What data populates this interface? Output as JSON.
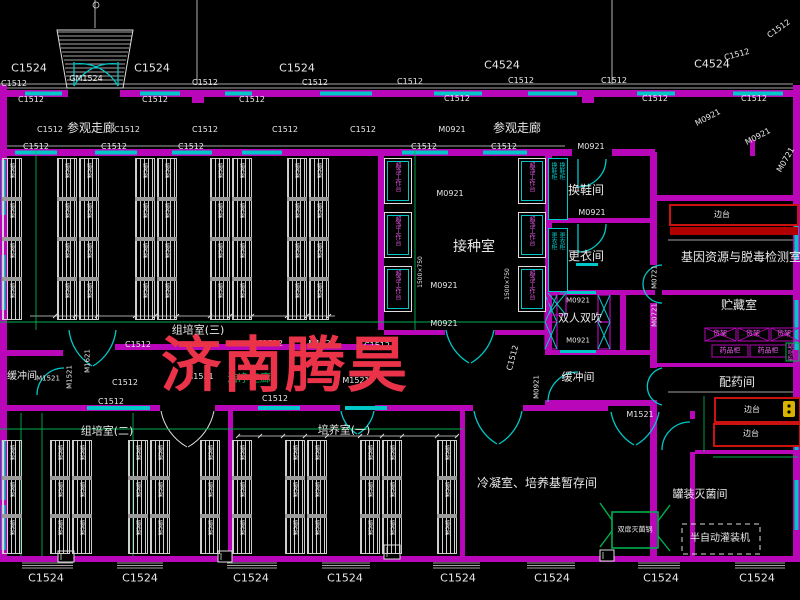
{
  "watermark": {
    "text": "济南腾昊",
    "color": "#ea3348"
  },
  "colors": {
    "wall": "#b806b8",
    "window": "#00c8c8",
    "line": "#dcdcdc",
    "green": "#00b050",
    "red": "#cc1111",
    "bench_red": "#b00000",
    "magenta_text": "#e85ae8",
    "yellow": "#d8b400",
    "text": "#e8e8e8"
  },
  "rooms": [
    "参观走廊",
    "组培室(三)",
    "接种室",
    "换鞋间",
    "更衣间",
    "双人双吹",
    "缓冲间",
    "洁净走廊",
    "基因资源与脱毒检测室",
    "贮藏室",
    "配药间",
    "罐装灭菌间",
    "组培室(二)",
    "培养室(一)",
    "冷凝室、培养基暂存间"
  ],
  "window_door_tags": [
    "C1524",
    "C4524",
    "C1512",
    "GM1524",
    "M0921",
    "M0721",
    "M1521",
    "M1621"
  ],
  "equipment": {
    "rack": "培养架",
    "clean_bench": "超净工作台",
    "shoe_cabinet": "换鞋柜",
    "wardrobe": "更衣柜",
    "side_bench": "边台",
    "shelf": "货架",
    "medicine_cabinet": "药品柜",
    "sterilizer": "双扉灭菌锅",
    "filler": "半自动灌装机"
  },
  "labels": [
    [
      "C1524",
      29,
      68,
      11
    ],
    [
      "C1524",
      152,
      68,
      11
    ],
    [
      "C1524",
      297,
      68,
      11
    ],
    [
      "C4524",
      502,
      65,
      11
    ],
    [
      "C4524",
      712,
      64,
      11
    ],
    [
      "C1512",
      737,
      55,
      8,
      null,
      -15
    ],
    [
      "C1512",
      779,
      29,
      8,
      null,
      -35
    ],
    [
      "GM1524",
      86,
      79,
      8
    ],
    [
      "C1512",
      14,
      84,
      8
    ],
    [
      "C1512",
      205,
      83,
      8
    ],
    [
      "C1512",
      315,
      83,
      8
    ],
    [
      "C1512",
      410,
      82,
      8
    ],
    [
      "C1512",
      521,
      81,
      8
    ],
    [
      "C1512",
      614,
      81,
      8
    ],
    [
      "C1512",
      31,
      100,
      8
    ],
    [
      "C1512",
      155,
      100,
      8
    ],
    [
      "C1512",
      252,
      100,
      8
    ],
    [
      "C1512",
      457,
      99,
      8
    ],
    [
      "C1512",
      655,
      99,
      8
    ],
    [
      "C1512",
      754,
      99,
      8
    ],
    [
      "参观走廊",
      91,
      128,
      12
    ],
    [
      "参观走廊",
      517,
      128,
      12
    ],
    [
      "C1512",
      50,
      130,
      8
    ],
    [
      "C1512",
      127,
      130,
      8
    ],
    [
      "C1512",
      205,
      130,
      8
    ],
    [
      "C1512",
      285,
      130,
      8
    ],
    [
      "C1512",
      363,
      130,
      8
    ],
    [
      "M0921",
      452,
      130,
      8
    ],
    [
      "M0921",
      708,
      118,
      8,
      null,
      -28
    ],
    [
      "M0921",
      758,
      137,
      8,
      null,
      -28
    ],
    [
      "M0721",
      786,
      160,
      8,
      null,
      -60
    ],
    [
      "C1512",
      36,
      147,
      8
    ],
    [
      "C1512",
      114,
      147,
      8
    ],
    [
      "C1512",
      191,
      147,
      8
    ],
    [
      "C1512",
      424,
      147,
      8
    ],
    [
      "C1512",
      504,
      147,
      8
    ],
    [
      "M0921",
      591,
      147,
      8
    ],
    [
      "M0921",
      450,
      194,
      8
    ],
    [
      "接种室",
      474,
      247,
      14
    ],
    [
      "M0921",
      444,
      286,
      8
    ],
    [
      "M0921",
      444,
      324,
      8
    ],
    [
      "1500×750",
      421,
      272,
      6,
      null,
      -90
    ],
    [
      "1500×750",
      508,
      284,
      6,
      null,
      -90
    ],
    [
      "换鞋间",
      586,
      190,
      12
    ],
    [
      "M0921",
      592,
      213,
      8
    ],
    [
      "更衣间",
      586,
      256,
      12
    ],
    [
      "双人双吹",
      580,
      318,
      11
    ],
    [
      "M0921",
      578,
      301,
      7
    ],
    [
      "M0921",
      578,
      341,
      7
    ],
    [
      "缓冲间",
      578,
      377,
      11
    ],
    [
      "M0921",
      537,
      387,
      7,
      null,
      -90
    ],
    [
      "C1512",
      513,
      358,
      8,
      null,
      -75
    ],
    [
      "M0721",
      655,
      277,
      7,
      null,
      -90
    ],
    [
      "M0721",
      655,
      315,
      7,
      null,
      -90
    ],
    [
      "基因资源与脱毒检测室",
      741,
      257,
      12
    ],
    [
      "边台",
      722,
      215,
      8
    ],
    [
      "贮藏室",
      739,
      305,
      12
    ],
    [
      "货架",
      720,
      334,
      7,
      "m"
    ],
    [
      "货架",
      753,
      334,
      7,
      "m"
    ],
    [
      "货架",
      784,
      334,
      7,
      "m"
    ],
    [
      "药品柜",
      730,
      351,
      7,
      "m"
    ],
    [
      "药品柜",
      768,
      351,
      7,
      "m"
    ],
    [
      "药品柜",
      792,
      352,
      6,
      "m",
      -90
    ],
    [
      "配药间",
      737,
      382,
      12
    ],
    [
      "边台",
      752,
      410,
      8
    ],
    [
      "边台",
      751,
      434,
      8
    ],
    [
      "罐装灭菌间",
      700,
      494,
      11
    ],
    [
      "半自动灌装机",
      720,
      539,
      10
    ],
    [
      "双扉灭菌锅",
      635,
      530,
      7
    ],
    [
      "冷凝室、培养基暂存间",
      537,
      483,
      12
    ],
    [
      "M1521",
      640,
      415,
      8
    ],
    [
      "组培室(三)",
      198,
      330,
      11
    ],
    [
      "组培室(二)",
      107,
      431,
      11
    ],
    [
      "培养室(一)",
      344,
      430,
      11
    ],
    [
      "洁净走廊",
      249,
      378,
      11,
      "g"
    ],
    [
      "缓冲间",
      22,
      377,
      10
    ],
    [
      "M1521",
      48,
      379,
      7
    ],
    [
      "M1621",
      88,
      361,
      7,
      null,
      -90
    ],
    [
      "M1521",
      70,
      377,
      7,
      null,
      -90
    ],
    [
      "C1512",
      138,
      345,
      8
    ],
    [
      "C1512",
      270,
      344,
      8
    ],
    [
      "M1521",
      322,
      344,
      8
    ],
    [
      "C1512",
      377,
      346,
      8
    ],
    [
      "M1521",
      200,
      377,
      8
    ],
    [
      "M1521",
      356,
      381,
      8
    ],
    [
      "C1512",
      125,
      383,
      8
    ],
    [
      "C1512",
      275,
      399,
      8
    ],
    [
      "C1512",
      111,
      402,
      8
    ],
    [
      "C1524",
      46,
      578,
      11
    ],
    [
      "C1524",
      140,
      578,
      11
    ],
    [
      "C1524",
      251,
      578,
      11
    ],
    [
      "C1524",
      345,
      578,
      11
    ],
    [
      "C1524",
      458,
      578,
      11
    ],
    [
      "C1524",
      552,
      578,
      11
    ],
    [
      "C1524",
      661,
      578,
      11
    ],
    [
      "C1524",
      757,
      578,
      11
    ]
  ]
}
